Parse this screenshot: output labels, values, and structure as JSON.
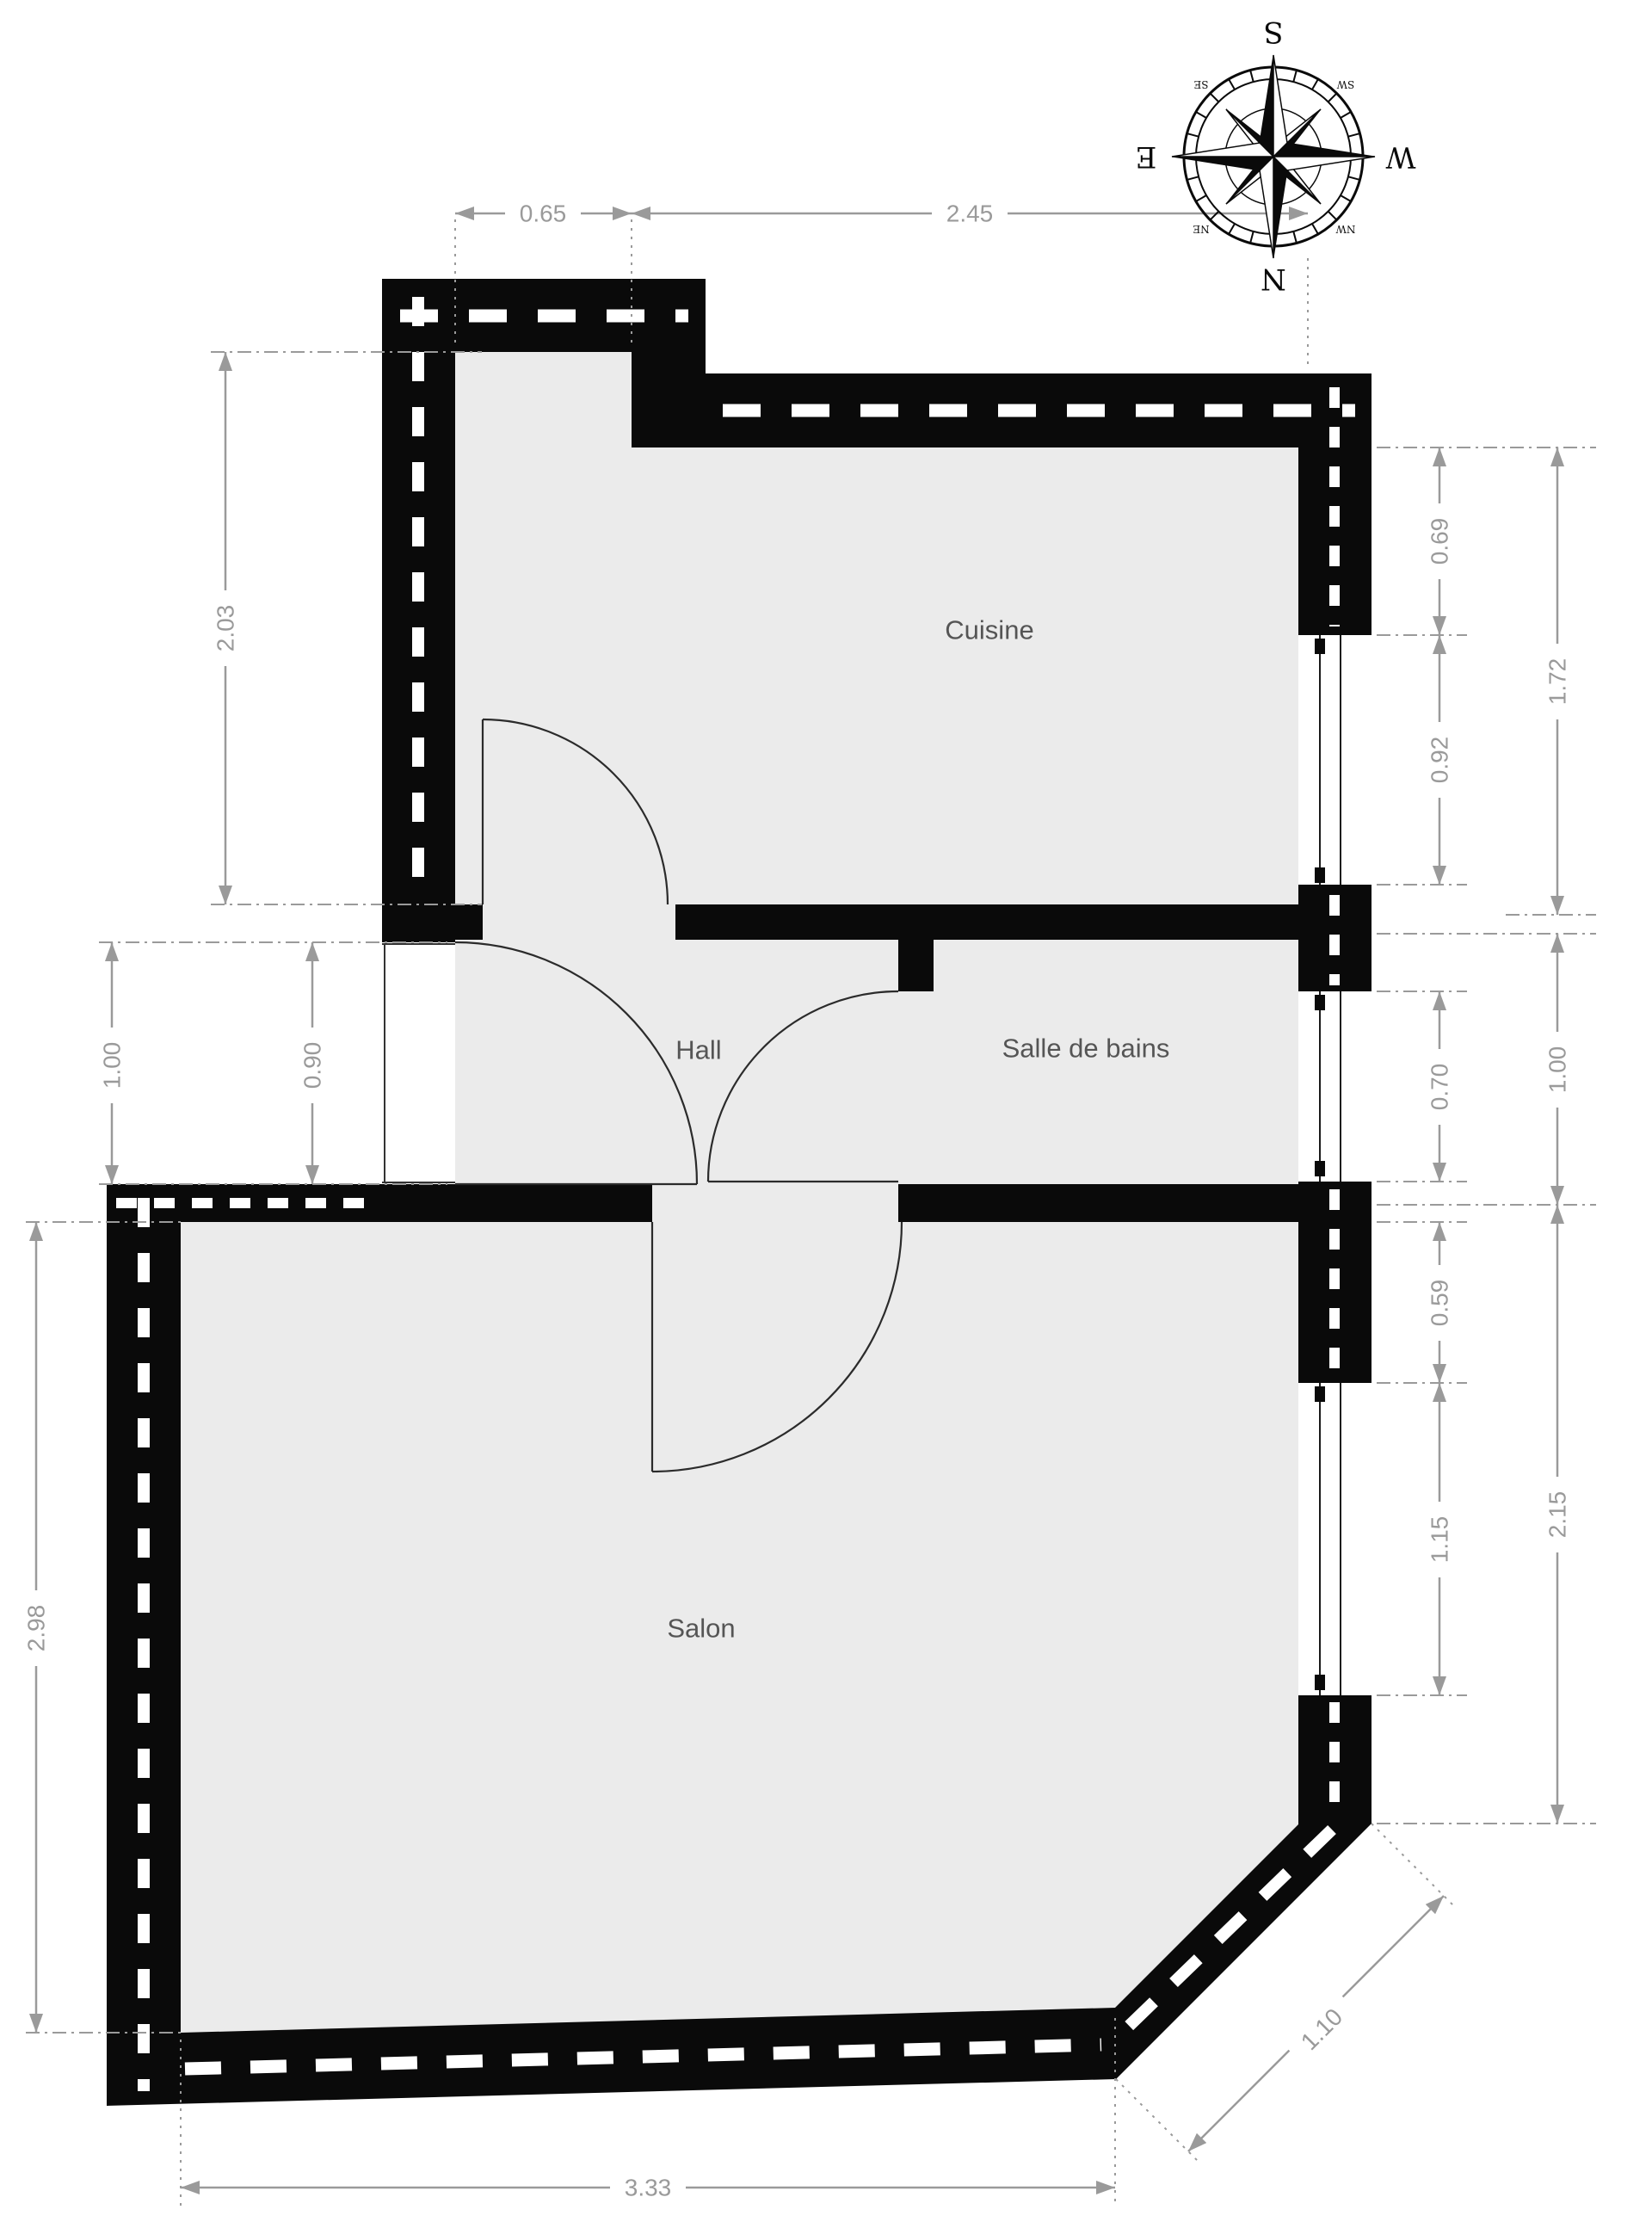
{
  "plan_title": "Floor plan",
  "rooms": {
    "cuisine": "Cuisine",
    "hall": "Hall",
    "bathroom": "Salle de bains",
    "living": "Salon"
  },
  "dims": {
    "top_left": "0.65",
    "top_right": "2.45",
    "cuisine_left": "2.03",
    "hall_left_outer": "1.00",
    "hall_left_inner": "0.90",
    "salon_left": "2.98",
    "cuisine_win_upper": "0.69",
    "cuisine_win": "0.92",
    "cuisine_right_total": "1.72",
    "bath_win": "0.70",
    "bath_right_total": "1.00",
    "salon_win_upper": "0.59",
    "salon_win": "1.15",
    "salon_right_total": "2.15",
    "salon_bottom": "3.33",
    "salon_diagonal": "1.10"
  },
  "compass": {
    "north": "N",
    "south": "S",
    "east": "E",
    "west": "W",
    "northeast": "NE",
    "northwest": "NW",
    "southeast": "SE",
    "southwest": "SW"
  },
  "colors": {
    "wall": "#0a0a0a",
    "room_fill": "#ebebeb",
    "dimension": "#9a9a9a",
    "room_label": "#555555",
    "background": "#ffffff"
  }
}
